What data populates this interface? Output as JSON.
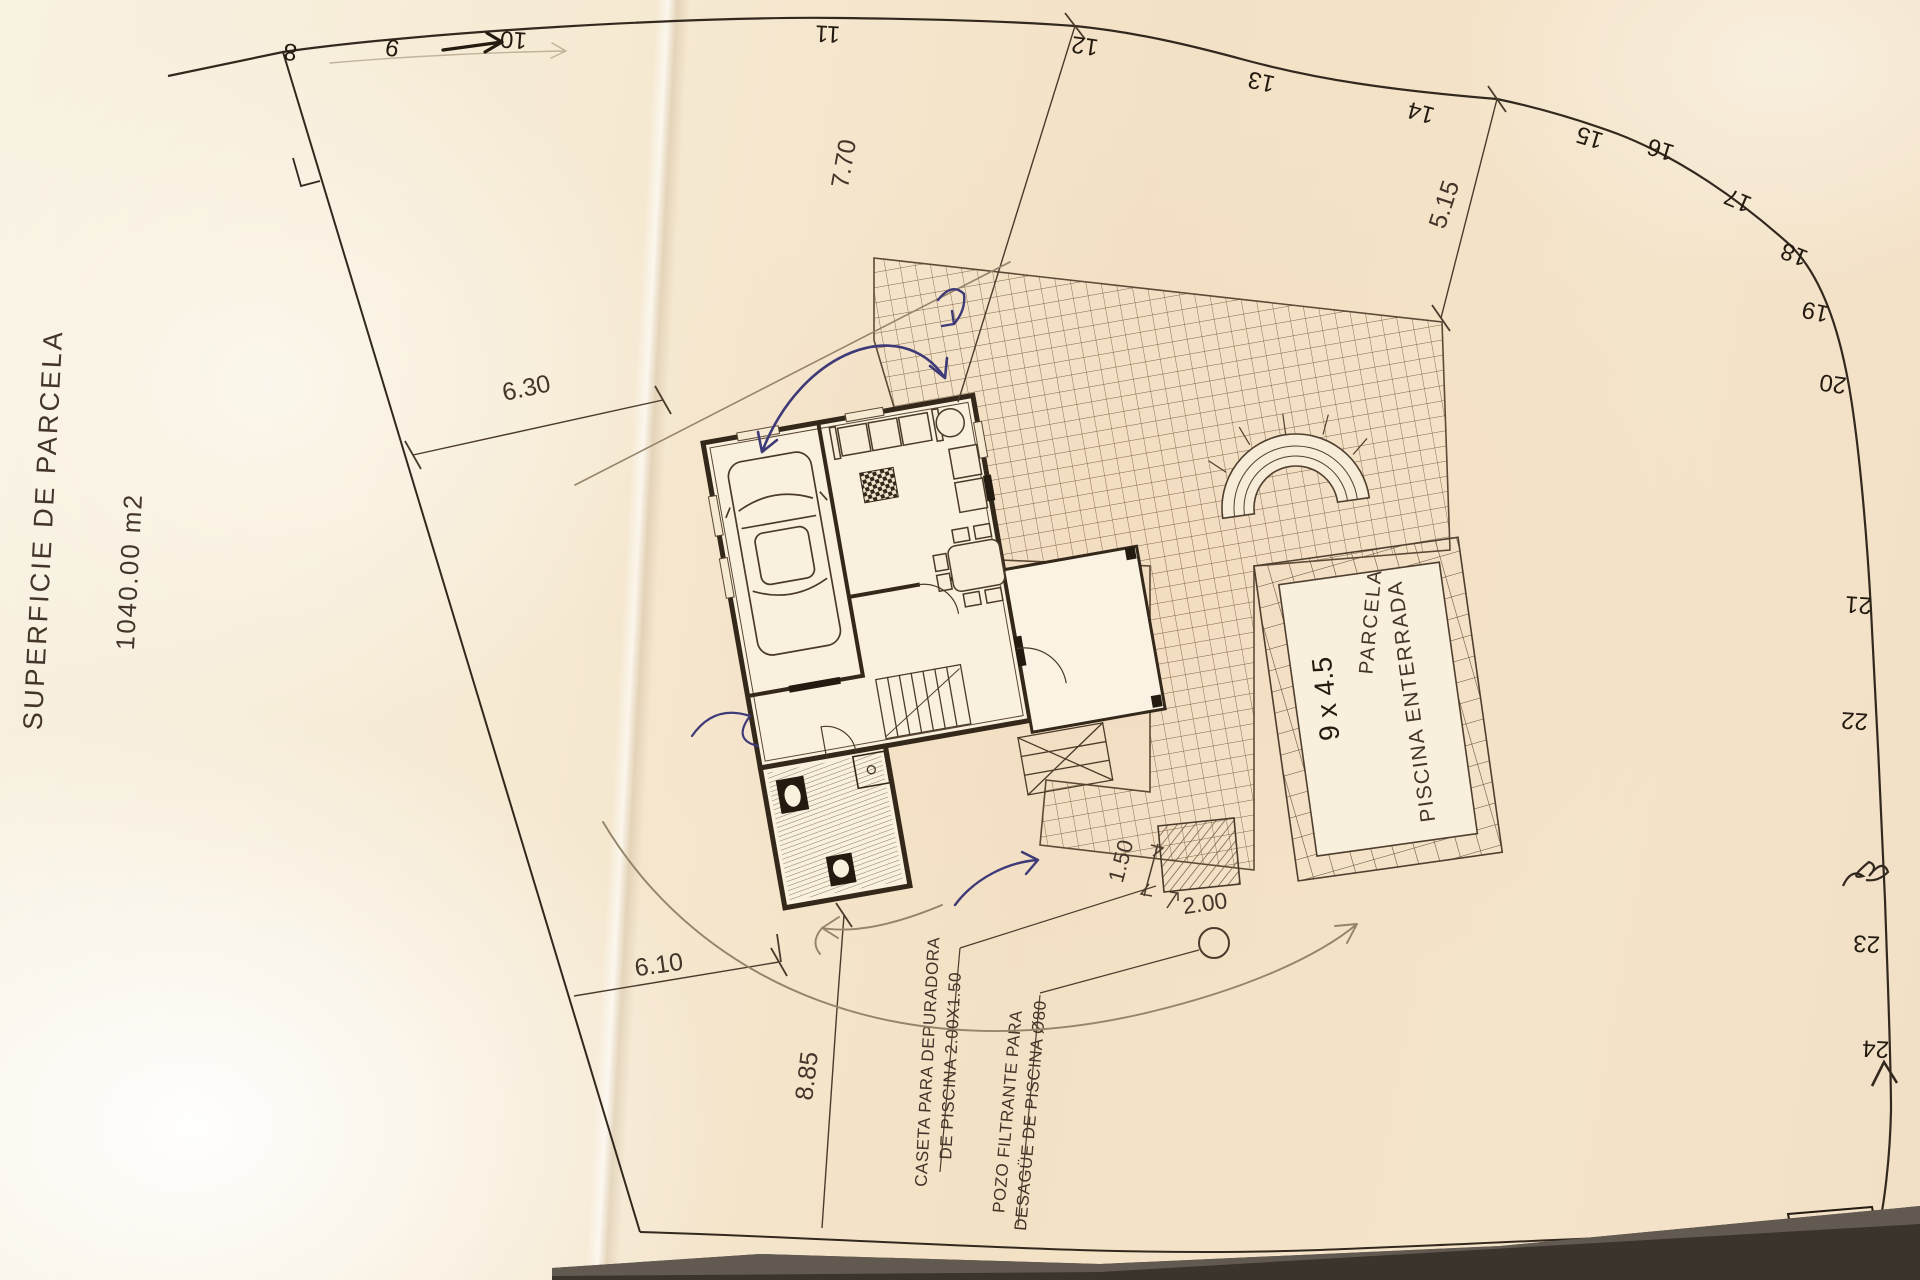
{
  "sheet": {
    "margin_title": "SUPERFICIE DE PARCELA",
    "margin_area": "1040.00 m2",
    "parcel_label": "PARCELA",
    "corner_note": "5/9"
  },
  "plan": {
    "pool_label": "PISCINA ENTERRADA",
    "pool_size_note": "9 x 4.5",
    "caseta_note_line1": "CASETA PARA DEPURADORA",
    "caseta_note_line2": "DE PISCINA 2.00X1.50",
    "pozo_note_line1": "POZO FILTRANTE PARA",
    "pozo_note_line2": "DESAGÜE DE PISCINA Ø80"
  },
  "dimensions": {
    "top_left": "6.30",
    "house_to_top_boundary": "7.70",
    "terrace_to_boundary": "5.15",
    "bottom_left": "6.10",
    "bottom_diagonal": "8.85",
    "caseta_width": "1.50",
    "pozo_offset": "2.00"
  },
  "boundary_marks": [
    "8",
    "9",
    "10",
    "11",
    "12",
    "13",
    "14",
    "15",
    "16",
    "17",
    "18",
    "19",
    "20",
    "21",
    "22",
    "23",
    "24"
  ]
}
